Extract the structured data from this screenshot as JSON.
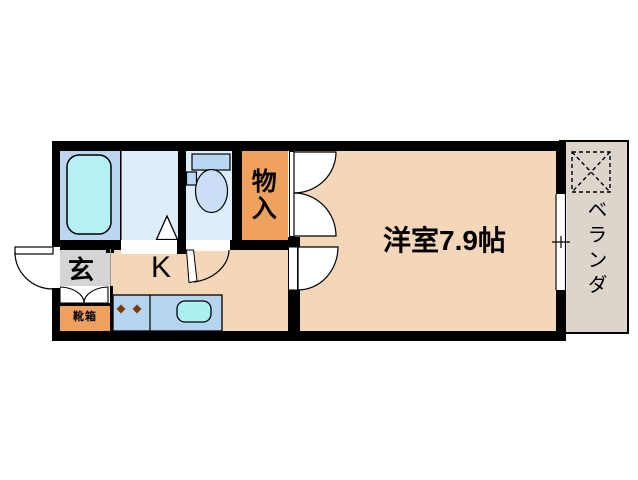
{
  "floor_plan": {
    "rooms": {
      "western_room": {
        "label": "洋室7.9帖",
        "size_jo": "7.9"
      },
      "kitchen": {
        "label": "K"
      },
      "entrance": {
        "label": "玄"
      },
      "shoe_cabinet": {
        "label": "靴箱"
      },
      "storage": {
        "label": "物入"
      },
      "veranda": {
        "label": "ベランダ"
      }
    },
    "colors": {
      "wall": "#000000",
      "room_floor": "#f4d6b8",
      "entrance_floor": "#d4d4d4",
      "storage_fill": "#efa15e",
      "shoe_cabinet_fill": "#efa15e",
      "bathroom_floor": "#bcd6f0",
      "washroom_floor": "#ddedfa",
      "toilet_floor": "#ddedfa",
      "bathtub_fill": "#b4f0f4",
      "sink_fill": "#aeeff2",
      "counter_fill": "#b5d4f0",
      "toilet_tank_fill": "#b9d6f2",
      "toilet_bowl_fill": "#cadff5",
      "veranda_fill": "#dcd5cb",
      "burner_color": "#7e3a12",
      "door_fill": "#ffffff"
    }
  }
}
